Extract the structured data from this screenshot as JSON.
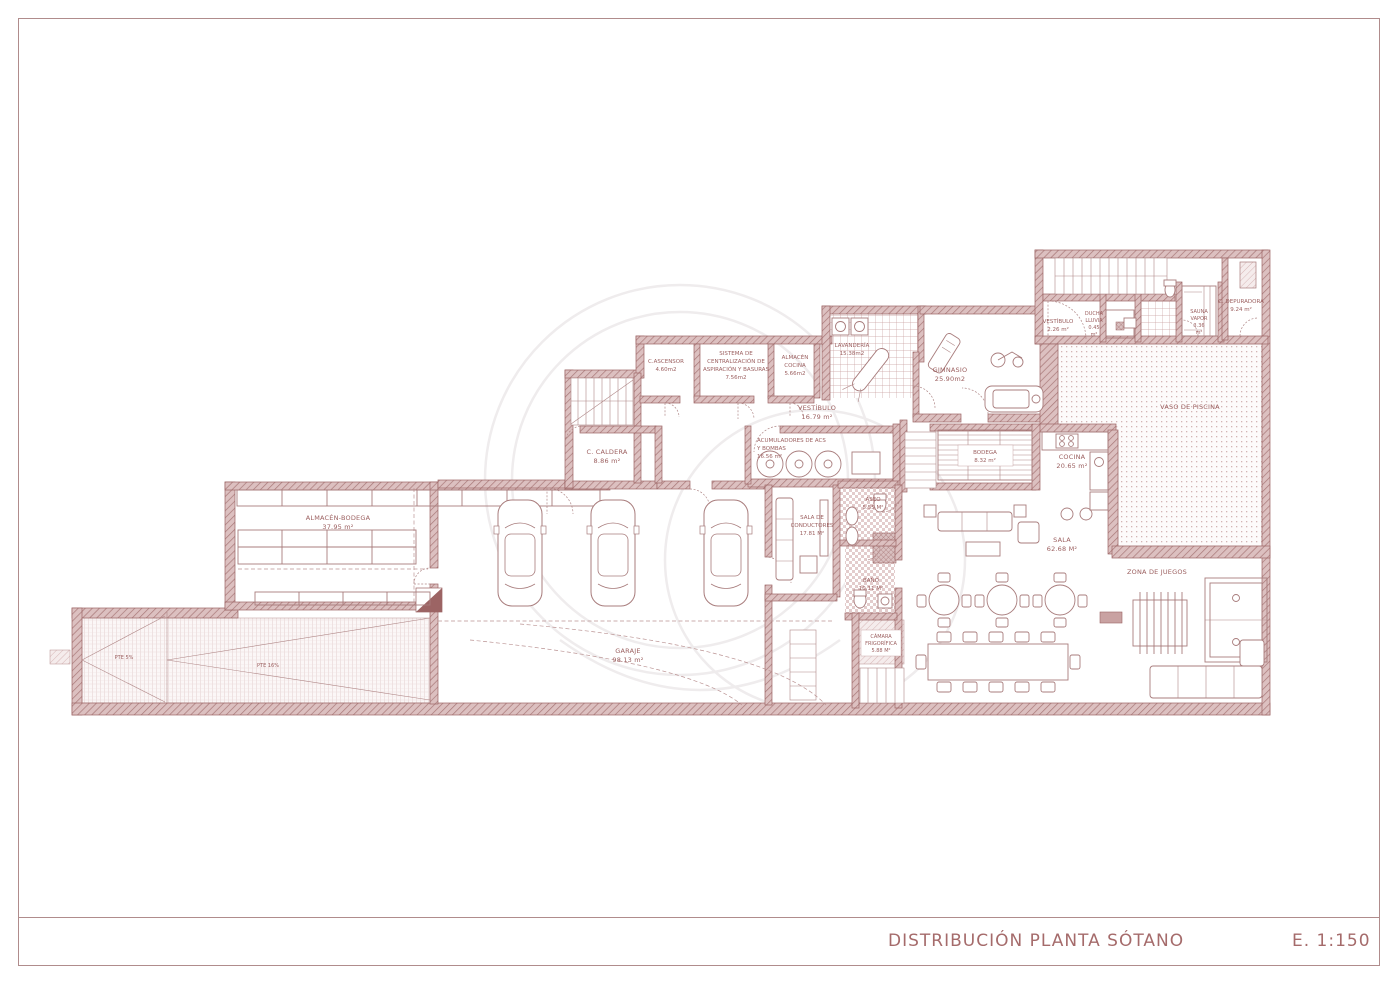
{
  "title_block": {
    "title": "DISTRIBUCIÓN PLANTA SÓTANO",
    "scale": "E.  1:150"
  },
  "colors": {
    "ink": "#9c6464",
    "wall_fill": "#d9bcbc",
    "wall_hatch": "#a87878",
    "watermark": "#efeced"
  },
  "labels": {
    "almacen_bodega": [
      "ALMACÉN-BODEGA",
      "37.95 m²"
    ],
    "garaje": [
      "GARAJE",
      "98.13 m²"
    ],
    "rampa": [
      "PTE 5%",
      "PTE 16%"
    ],
    "ascensor": [
      "C.ASCENSOR",
      "4.60m2"
    ],
    "sistema": [
      "SISTEMA DE",
      "CENTRALIZACIÓN DE",
      "ASPIRACIÓN Y BASURAS",
      "7.56m2"
    ],
    "almacen_cocina": [
      "ALMACÉN",
      "COCINA",
      "5.66m2"
    ],
    "lavanderia": [
      "LAVANDERÍA",
      "15.38m2"
    ],
    "gimnasio": [
      "GIMNASIO",
      "25.90m2"
    ],
    "vestibulo": [
      "VESTÍBULO",
      "16.79 m²"
    ],
    "caldera": [
      "C. CALDERA",
      "8.86 m²"
    ],
    "acumuladores": [
      "ACUMULADORES DE ACS",
      "Y BOMBAS",
      "16.56 m²"
    ],
    "bodega": [
      "BODEGA",
      "8.32 m²"
    ],
    "cocina": [
      "COCINA",
      "20.65 m²"
    ],
    "vaso_piscina": [
      "VASO DE PISCINA"
    ],
    "vestibulo2": [
      "VESTÍBULO",
      "2.26 m²"
    ],
    "ducha": [
      "DUCHA",
      "LLUVIA",
      "0.45",
      "m²"
    ],
    "sauna": [
      "SAUNA",
      "VAPOR",
      "3.36",
      "m²"
    ],
    "depuradora": [
      "C. DEPURADORA",
      "9.24 m²"
    ],
    "sala": [
      "SALA",
      "62.68 M²"
    ],
    "zona_juegos": [
      "ZONA DE JUEGOS"
    ],
    "conductores": [
      "SALA DE",
      "CONDUCTORES",
      "17.81 M²"
    ],
    "aseo": [
      "ASEO",
      "5.55 M²"
    ],
    "bano": [
      "BAÑO",
      "10.11 M²"
    ],
    "camara": [
      "CÁMARA",
      "FRIGORÍFICA",
      "5.88 M²"
    ]
  }
}
